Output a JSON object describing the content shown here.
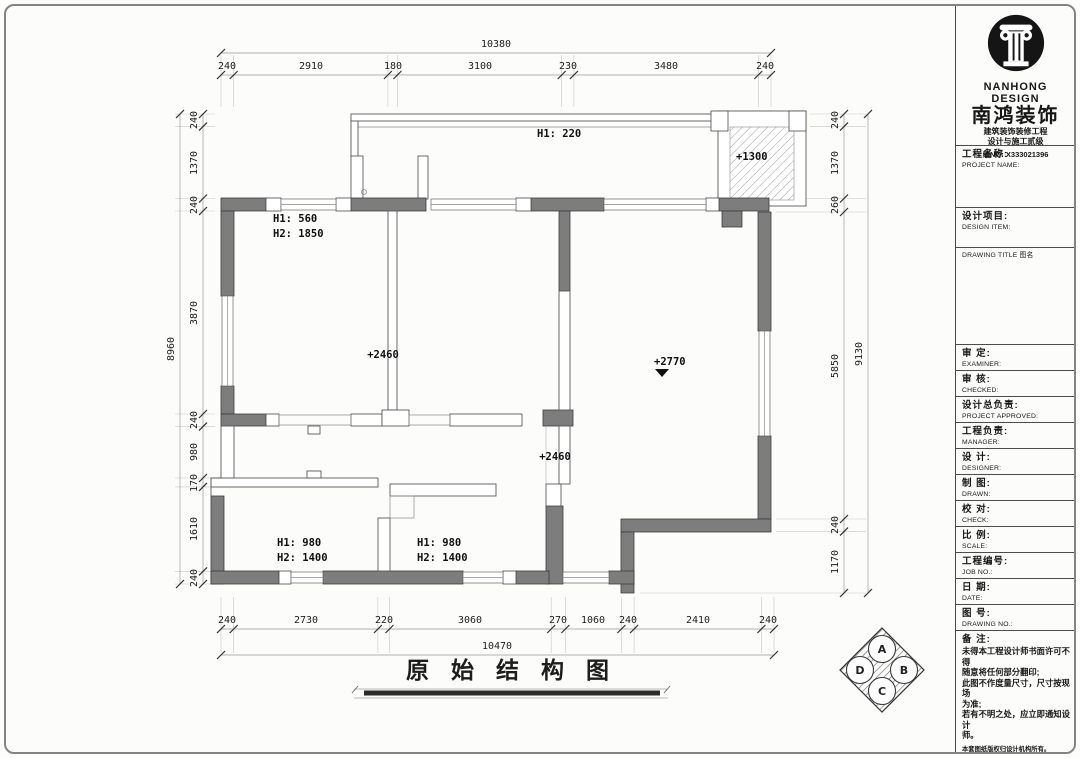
{
  "drawing": {
    "title": "原 始 结 构 图",
    "labels": {
      "balcony": "H1: 220",
      "shaft": "+1300",
      "room1_line1": "H1: 560",
      "room1_line2": "H2: 1850",
      "level_mid": "+2460",
      "level_low": "+2460",
      "level_main": "+2770",
      "bottom_left_line1": "H1: 980",
      "bottom_left_line2": "H2: 1400",
      "bottom_mid_line1": "H1: 980",
      "bottom_mid_line2": "H2: 1400"
    }
  },
  "dims": {
    "top": {
      "overall": "10380",
      "segments": [
        "240",
        "2910",
        "180",
        "3100",
        "230",
        "3480",
        "240"
      ]
    },
    "bottom": {
      "overall": "10470",
      "segments": [
        "240",
        "2730",
        "220",
        "3060",
        "270",
        "1060",
        "240",
        "2410",
        "240"
      ]
    },
    "left": {
      "overall": "8960",
      "segments": [
        "240",
        "1370",
        "240",
        "3870",
        "240",
        "980",
        "170",
        "1610",
        "240"
      ]
    },
    "right": {
      "overall": "9130",
      "segments": [
        "240",
        "1370",
        "260",
        "5850",
        "240",
        "1170"
      ]
    }
  },
  "compass": {
    "a": "A",
    "b": "B",
    "c": "C",
    "d": "D"
  },
  "sidebar": {
    "logo": {
      "en": "NANHONG DESIGN",
      "cn": "南鸿装饰",
      "line1": "建筑装饰装修工程",
      "line2": "设计与施工贰级",
      "line3": "编NO: X333021396"
    },
    "fields": [
      {
        "cn": "工程名称:",
        "en": "PROJECT NAME:"
      },
      {
        "cn": "设计项目:",
        "en": "DESIGN ITEM:"
      },
      {
        "cn": "审  定:",
        "en": "EXAMINER:"
      },
      {
        "cn": "审  核:",
        "en": "CHECKED:"
      },
      {
        "cn": "设计总负责:",
        "en": "PROJECT APPROVED:"
      },
      {
        "cn": "工程负责:",
        "en": "MANAGER:"
      },
      {
        "cn": "设  计:",
        "en": "DESIGNER:"
      },
      {
        "cn": "制  图:",
        "en": "DRAWN:"
      },
      {
        "cn": "校  对:",
        "en": "CHECK:"
      },
      {
        "cn": "比  例:",
        "en": "SCALE:"
      },
      {
        "cn": "工程编号:",
        "en": "JOB NO.:"
      },
      {
        "cn": "日  期:",
        "en": "DATE:"
      },
      {
        "cn": "图  号:",
        "en": "DRAWING NO.:"
      }
    ],
    "drawing_title_row": "DRAWING TITLE 图名",
    "notes": {
      "header": "备  注:",
      "lines": [
        "未得本工程设计师书面许可不得",
        "随意将任何部分翻印;",
        "此图不作度量尺寸，尺寸按现场",
        "为准;",
        "若有不明之处，应立即通知设计",
        "师。",
        "本套图纸版权归设计机构所有。"
      ],
      "hotline": "免费咨询电话:18387543593"
    }
  }
}
